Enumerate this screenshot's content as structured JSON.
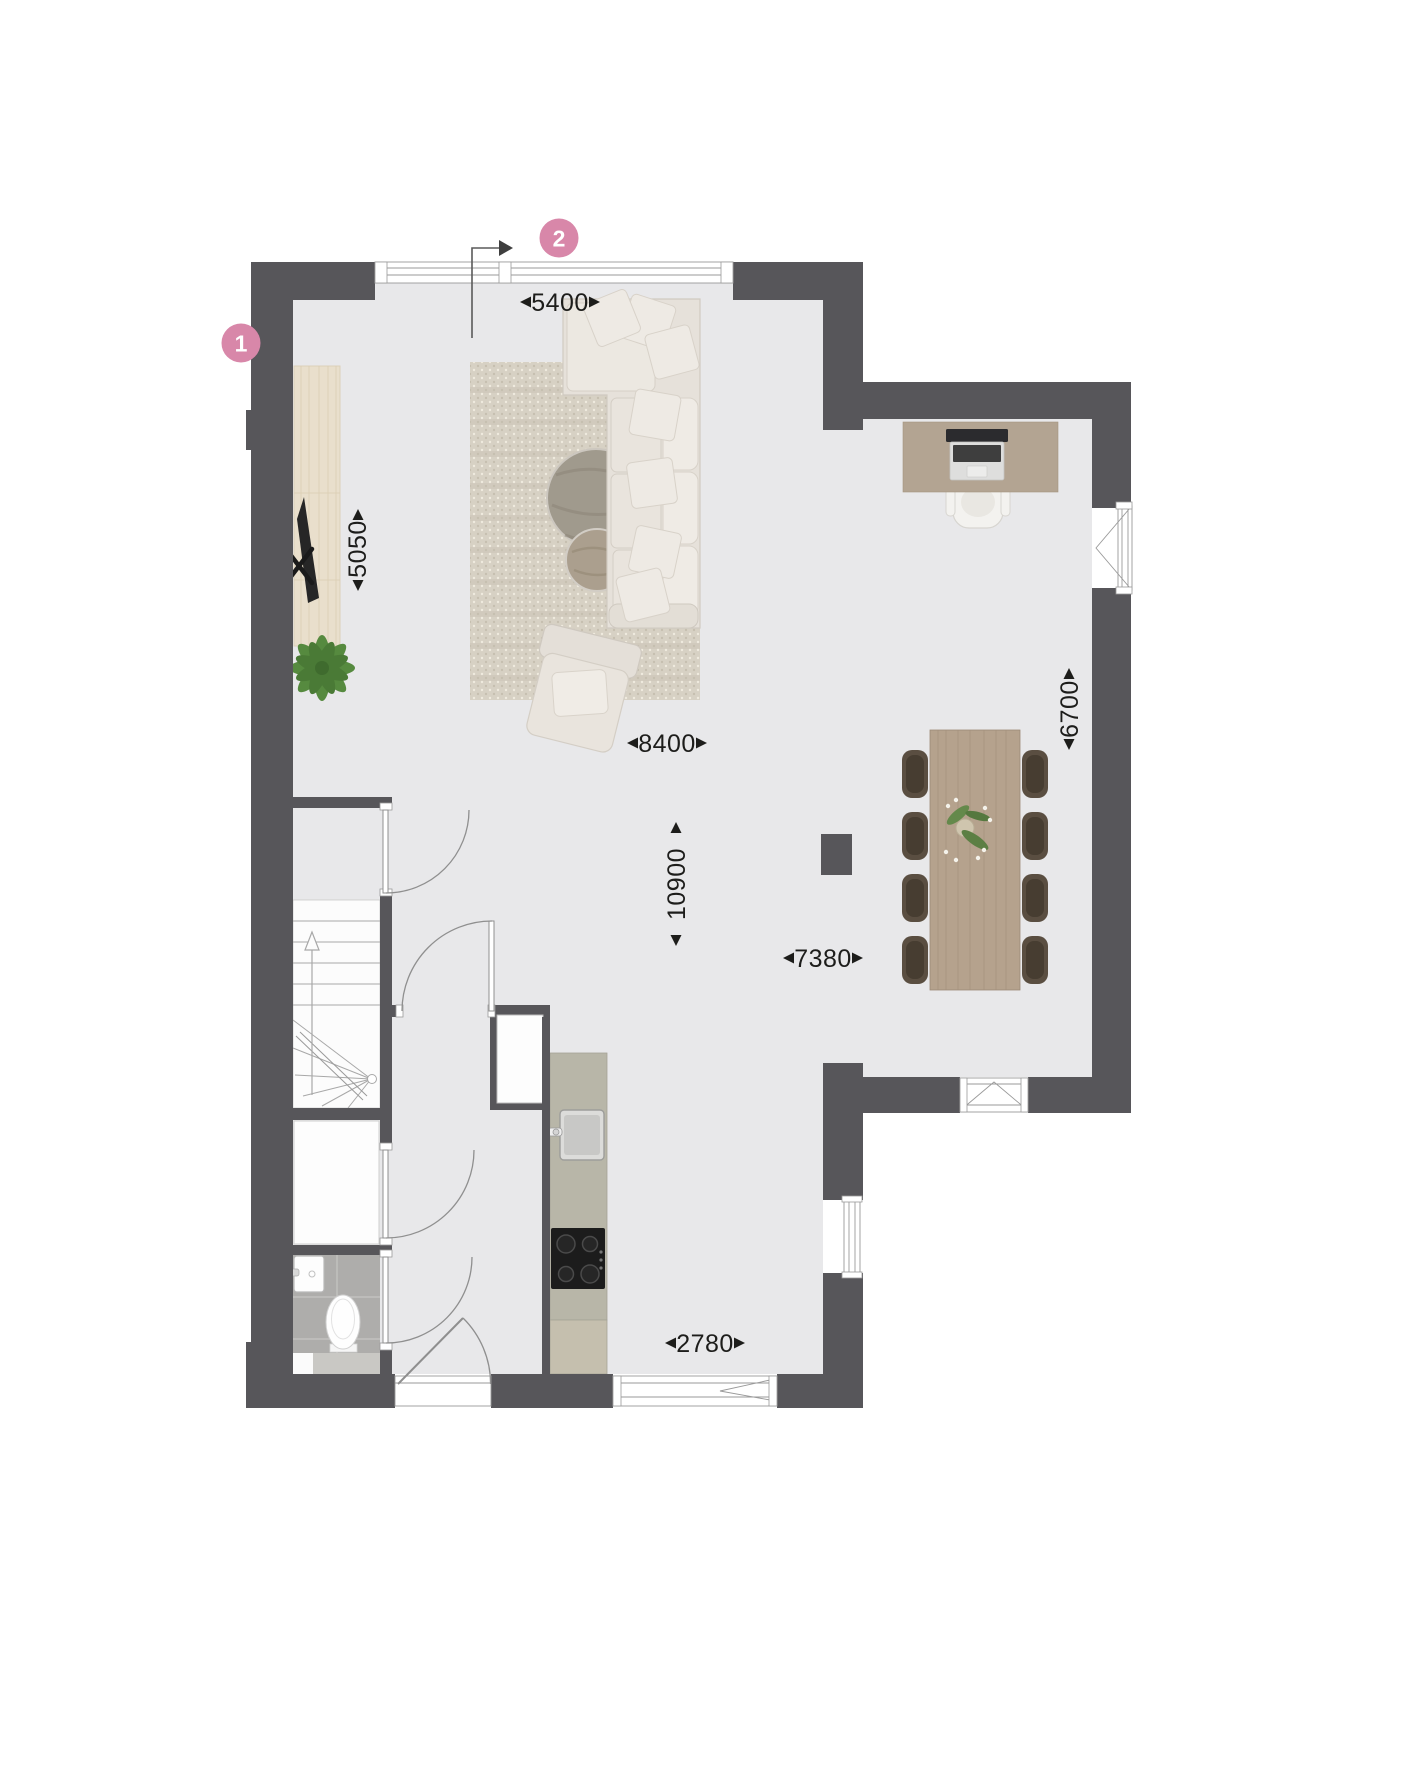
{
  "colors": {
    "wall": "#57565a",
    "floor": "#e8e8ea",
    "accent": "#d887a9",
    "text": "#1d1d1b",
    "wood": "#e9dfcc",
    "rug": "#d7d1c4",
    "cream": "#e8e3dc",
    "counter": "#b8b6a8",
    "tile": "#aeadab",
    "dining_table": "#b5a28d",
    "dining_chair": "#55493c",
    "desk": "#b3a492",
    "plant": "#4f7f3a"
  },
  "markers": [
    {
      "label": "1"
    },
    {
      "label": "2"
    }
  ],
  "dimensions": {
    "top_width": "5400",
    "tv_wall_height": "5050",
    "living_width": "8400",
    "living_depth": "10900",
    "dining_depth": "6700",
    "dining_width": "7380",
    "kitchen_width": "2780"
  }
}
